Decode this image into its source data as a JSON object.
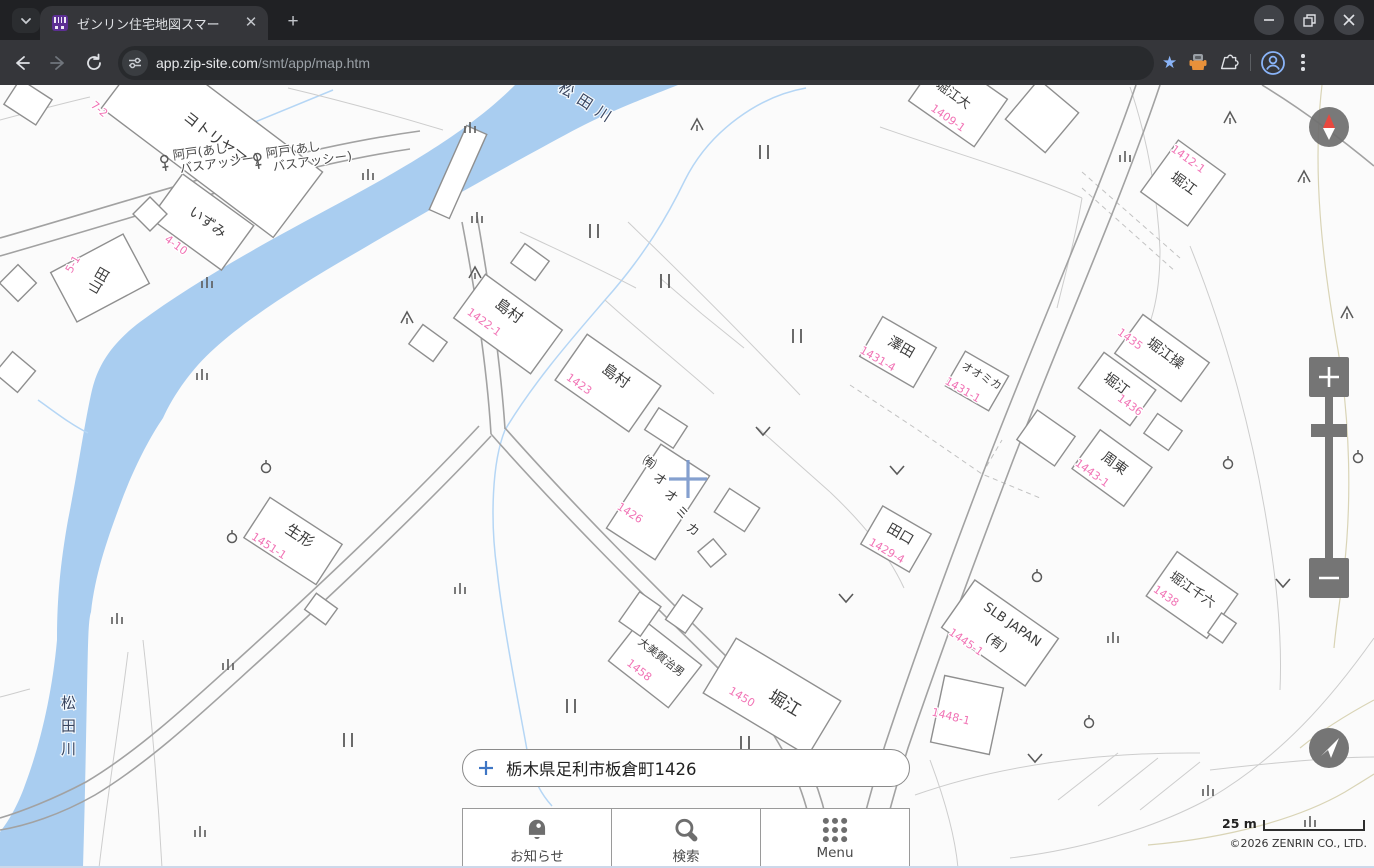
{
  "browser": {
    "tab_title": "ゼンリン住宅地図スマー",
    "url_host": "app.zip-site.com",
    "url_path": "/smt/app/map.htm"
  },
  "search": {
    "value": "栃木県足利市板倉町1426"
  },
  "bottom_nav": {
    "items": [
      {
        "label": "お知らせ",
        "icon": "bell-icon"
      },
      {
        "label": "検索",
        "icon": "search-icon"
      },
      {
        "label": "Menu",
        "icon": "menu-grid-icon"
      }
    ]
  },
  "map_footer": {
    "scale_label": "25 m",
    "copyright": "©2026 ZENRIN CO., LTD."
  },
  "controls": {
    "zoom_in": "+",
    "zoom_out": "−",
    "compass": "north",
    "locate": "current-location"
  },
  "map": {
    "colors": {
      "river": "#a9cdf0",
      "house_number": "#f173b5",
      "label": "#3c3c3c",
      "road": "#a2a2a2",
      "accent_crosshair": "#7b99cc",
      "control_gray": "#757575"
    },
    "river_labels": [
      {
        "text": "松田川",
        "x": 585,
        "y": 108,
        "rot": 33,
        "vertical": false
      },
      {
        "text": "松田川",
        "x": 72,
        "y": 708,
        "vertical": true,
        "step": 23
      }
    ],
    "bus_stops": [
      {
        "line1": "阿戸(あし",
        "line2": "バスアッシー)",
        "x": 165,
        "y": 164,
        "rot": -8
      },
      {
        "line1": "阿戸(あし",
        "line2": "バスアッシー)",
        "x": 258,
        "y": 162,
        "rot": -8
      }
    ],
    "buildings": [
      {
        "rect": [
          212,
          140,
          215,
          82,
          37
        ],
        "label": "ヨトリヤマ",
        "lx": 212,
        "ly": 142,
        "lrot": 38,
        "fs": 15,
        "num": "7-2",
        "nx": 97,
        "ny": 112,
        "nrot": 40
      },
      {
        "rect": [
          202,
          222,
          88,
          55,
          36
        ],
        "label": "いずみ",
        "lx": 205,
        "ly": 226,
        "lrot": 36,
        "fs": 14,
        "num": "4-10",
        "nx": 174,
        "ny": 248,
        "nrot": 36
      },
      {
        "rect": [
          100,
          278,
          82,
          56,
          -28
        ],
        "label": "山田",
        "lx": 103,
        "ly": 283,
        "lrot": -60,
        "fs": 14,
        "num": "5-1",
        "nx": 76,
        "ny": 266,
        "nrot": -60
      },
      {
        "rect": [
          508,
          324,
          95,
          54,
          36
        ],
        "label": "島村",
        "lx": 506,
        "ly": 315,
        "lrot": 36,
        "fs": 15,
        "num": "1422-1",
        "nx": 482,
        "ny": 325,
        "nrot": 36
      },
      {
        "rect": [
          608,
          383,
          90,
          56,
          35
        ],
        "label": "島村",
        "lx": 613,
        "ly": 380,
        "lrot": 35,
        "fs": 15,
        "num": "1423",
        "nx": 577,
        "ny": 387,
        "nrot": 35
      },
      {
        "rect": [
          658,
          502,
          58,
          100,
          33
        ],
        "label": "㈲オオミカ",
        "vertical": true,
        "step": 20,
        "lx": 647,
        "ly": 466,
        "lrot": 33,
        "fs": 13,
        "num": "1426",
        "nx": 628,
        "ny": 516,
        "nrot": 33
      },
      {
        "rect": [
          293,
          541,
          86,
          48,
          33
        ],
        "label": "生形",
        "lx": 297,
        "ly": 540,
        "lrot": 33,
        "fs": 15,
        "num": "1451-1",
        "nx": 267,
        "ny": 549,
        "nrot": 33
      },
      {
        "rect": [
          898,
          352,
          62,
          46,
          30
        ],
        "label": "澤田",
        "lx": 899,
        "ly": 351,
        "lrot": 30,
        "fs": 14,
        "num": "1431-4",
        "nx": 876,
        "ny": 362,
        "nrot": 30
      },
      {
        "rect": [
          977,
          381,
          50,
          40,
          30
        ],
        "label": "オオミカ",
        "lx": 980,
        "ly": 379,
        "lrot": 30,
        "fs": 11,
        "num": "1431-1",
        "nx": 961,
        "ny": 393,
        "nrot": 30
      },
      {
        "rect": [
          896,
          539,
          56,
          44,
          30
        ],
        "label": "田口",
        "lx": 898,
        "ly": 538,
        "lrot": 30,
        "fs": 14,
        "num": "1429-4",
        "nx": 885,
        "ny": 554,
        "nrot": 30
      },
      {
        "rect": [
          1183,
          183,
          58,
          64,
          36
        ],
        "label": "堀江",
        "lx": 1181,
        "ly": 187,
        "lrot": 36,
        "fs": 14,
        "num": "1412-1",
        "nx": 1186,
        "ny": 162,
        "nrot": 36
      },
      {
        "rect": [
          1162,
          358,
          82,
          48,
          36
        ],
        "label": "堀江操",
        "lx": 1163,
        "ly": 357,
        "lrot": 36,
        "fs": 14,
        "num": "1435",
        "nx": 1128,
        "ny": 342,
        "nrot": 36
      },
      {
        "rect": [
          1117,
          389,
          64,
          44,
          36
        ],
        "label": "堀江",
        "lx": 1114,
        "ly": 388,
        "lrot": 36,
        "fs": 14,
        "num": "1436",
        "nx": 1128,
        "ny": 408,
        "nrot": 36
      },
      {
        "rect": [
          1112,
          468,
          64,
          48,
          36
        ],
        "label": "周東",
        "lx": 1112,
        "ly": 467,
        "lrot": 36,
        "fs": 14,
        "num": "1443-1",
        "nx": 1090,
        "ny": 476,
        "nrot": 36
      },
      {
        "rect": [
          1192,
          595,
          74,
          54,
          35
        ],
        "label": "堀江千六",
        "lx": 1190,
        "ly": 593,
        "lrot": 35,
        "fs": 13,
        "num": "1438",
        "nx": 1164,
        "ny": 599,
        "nrot": 35
      },
      {
        "rect": [
          655,
          663,
          76,
          54,
          38
        ],
        "label": "大美賀治男",
        "lx": 659,
        "ly": 660,
        "lrot": 38,
        "fs": 11,
        "num": "1458",
        "nx": 637,
        "ny": 673,
        "nrot": 38
      },
      {
        "rect": [
          772,
          697,
          122,
          64,
          31
        ],
        "label": "堀江",
        "lx": 782,
        "ly": 708,
        "lrot": 31,
        "fs": 17,
        "num": "1450",
        "nx": 740,
        "ny": 700,
        "nrot": 31
      },
      {
        "rect": [
          1000,
          633,
          102,
          58,
          35
        ],
        "label": "SLB JAPAN",
        "label2": "(有)",
        "l2x": 994,
        "l2y": 646,
        "lx": 1010,
        "ly": 628,
        "lrot": 35,
        "fs": 13,
        "num": "1445-1",
        "nx": 964,
        "ny": 645,
        "nrot": 35
      },
      {
        "rect": [
          967,
          715,
          60,
          68,
          12
        ],
        "num": "1448-1",
        "nx": 950,
        "ny": 720,
        "nrot": 14
      },
      {
        "rect": [
          958,
          100,
          80,
          58,
          35
        ],
        "label": "堀江大",
        "lx": 951,
        "ly": 98,
        "lrot": 35,
        "fs": 13,
        "num": "1409-1",
        "nx": 946,
        "ny": 121,
        "nrot": 35
      }
    ],
    "extra_buildings": [
      [
        428,
        343,
        30,
        24,
        36
      ],
      [
        530,
        262,
        30,
        24,
        36
      ],
      [
        150,
        214,
        24,
        24,
        45
      ],
      [
        18,
        283,
        26,
        26,
        45
      ],
      [
        321,
        609,
        26,
        20,
        36
      ],
      [
        640,
        614,
        26,
        36,
        35
      ],
      [
        684,
        614,
        24,
        30,
        35
      ],
      [
        737,
        510,
        36,
        28,
        33
      ],
      [
        712,
        553,
        20,
        20,
        50
      ],
      [
        666,
        428,
        34,
        26,
        33
      ],
      [
        1046,
        438,
        46,
        36,
        35
      ],
      [
        1163,
        432,
        30,
        24,
        35
      ],
      [
        1042,
        116,
        52,
        52,
        40
      ],
      [
        1222,
        628,
        18,
        24,
        35
      ],
      [
        15,
        372,
        30,
        28,
        40
      ],
      [
        28,
        102,
        38,
        30,
        33
      ]
    ],
    "symbols": {
      "conifer": [
        [
          697,
          125
        ],
        [
          475,
          273
        ],
        [
          407,
          318
        ],
        [
          1230,
          118
        ],
        [
          1304,
          177
        ],
        [
          1347,
          313
        ]
      ],
      "paddy": [
        [
          764,
          152
        ],
        [
          594,
          231
        ],
        [
          665,
          281
        ],
        [
          797,
          336
        ],
        [
          571,
          706
        ],
        [
          348,
          740
        ],
        [
          745,
          743
        ]
      ],
      "field": [
        [
          470,
          128
        ],
        [
          368,
          175
        ],
        [
          477,
          218
        ],
        [
          207,
          283
        ],
        [
          202,
          375
        ],
        [
          460,
          589
        ],
        [
          117,
          619
        ],
        [
          228,
          665
        ],
        [
          200,
          832
        ],
        [
          1125,
          157
        ],
        [
          1113,
          638
        ],
        [
          1208,
          791
        ],
        [
          1310,
          822
        ]
      ],
      "vee": [
        [
          763,
          431
        ],
        [
          897,
          470
        ],
        [
          846,
          598
        ],
        [
          1283,
          583
        ],
        [
          1035,
          758
        ]
      ],
      "pole": [
        [
          266,
          467
        ],
        [
          232,
          537
        ],
        [
          1358,
          457
        ],
        [
          1228,
          463
        ],
        [
          1037,
          576
        ],
        [
          1089,
          722
        ]
      ]
    }
  }
}
